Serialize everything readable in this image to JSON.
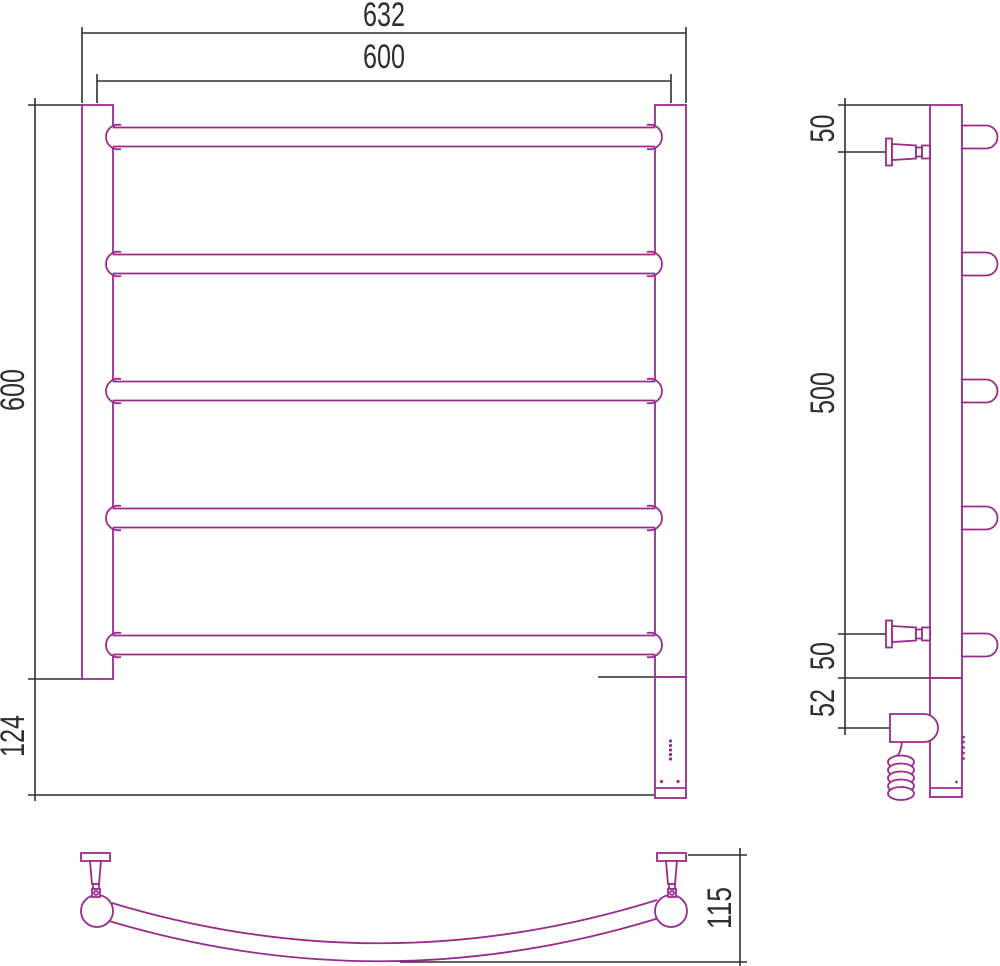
{
  "drawing": {
    "type": "technical-dimension-drawing",
    "subject": "ladder towel rail radiator, three orthographic views",
    "colors": {
      "outline": "#9A2B8C",
      "dimension": "#2F2F2F",
      "background": "#FFFFFF"
    },
    "front_view": {
      "width_overall": "632",
      "width_bars": "600",
      "height_bars": "600",
      "height_bottom": "124",
      "bar_count": 5
    },
    "side_view": {
      "offset_top": "50",
      "span_mounts": "500",
      "offset_bottom": "50",
      "offset_heater": "52"
    },
    "bottom_view": {
      "depth": "115"
    }
  }
}
